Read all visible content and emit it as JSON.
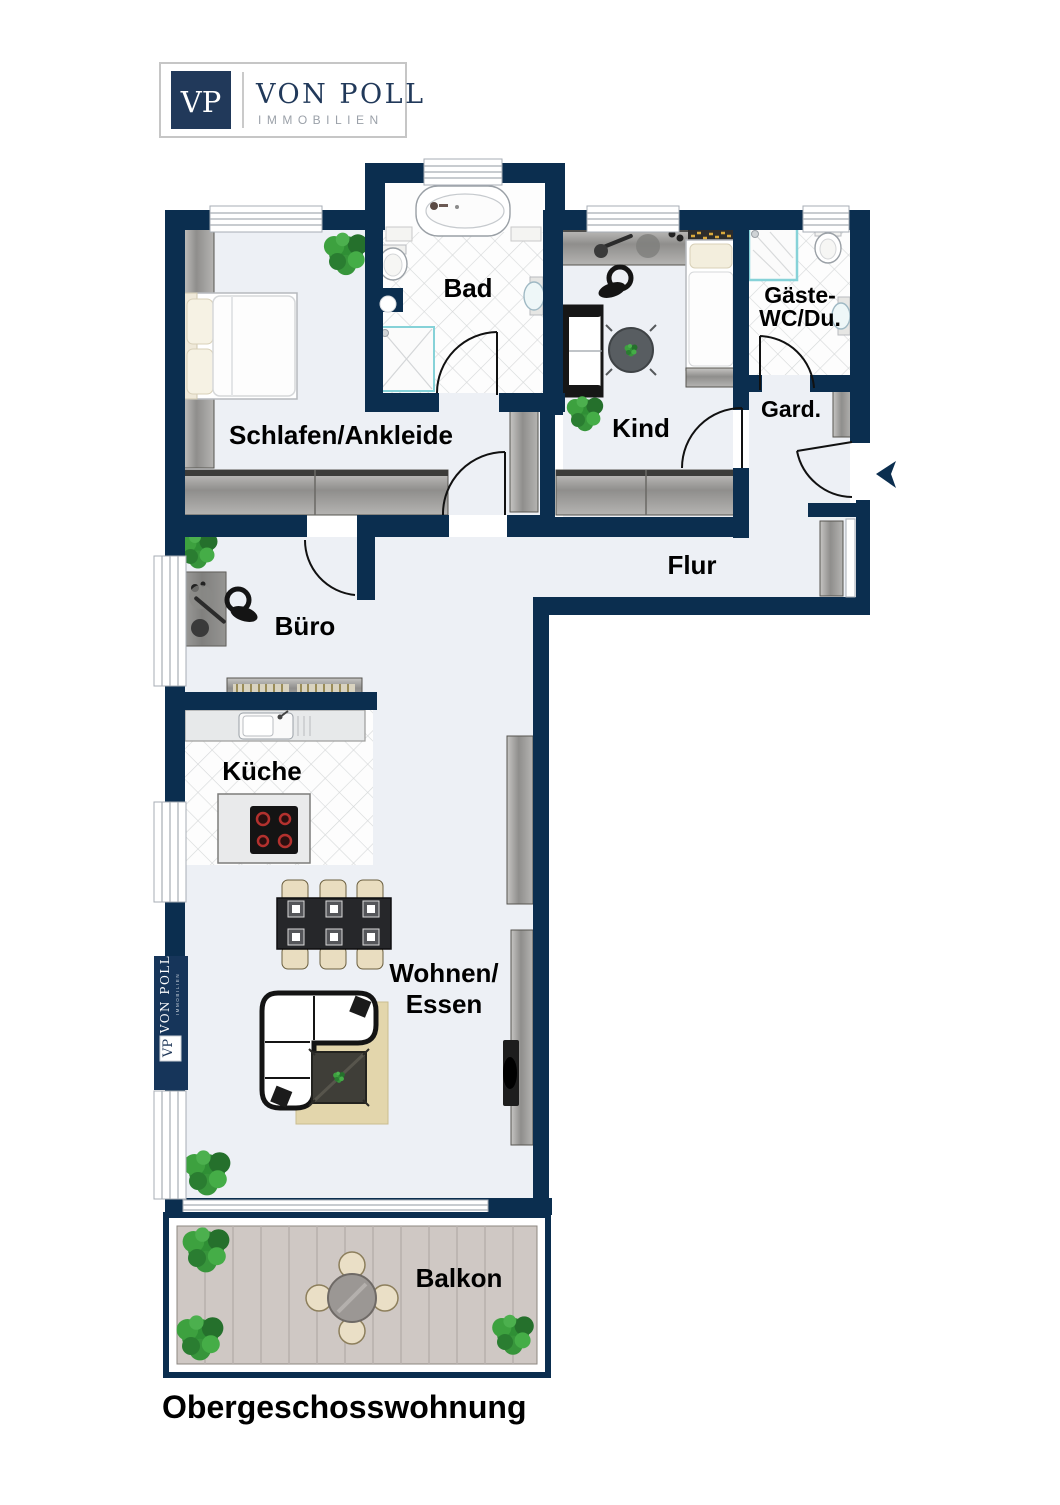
{
  "logo": {
    "monogram": "VP",
    "brand": "VON POLL",
    "division": "IMMOBILIEN"
  },
  "watermark": {
    "brand": "VON POLL",
    "division": "IMMOBILIEN",
    "monogram": "VP"
  },
  "plan_title": "Obergeschosswohnung",
  "rooms": {
    "bad": {
      "label": "Bad"
    },
    "schlafen": {
      "label": "Schlafen/Ankleide"
    },
    "kind": {
      "label": "Kind"
    },
    "gaeste": {
      "label_line1": "Gäste-",
      "label_line2": "WC/Du."
    },
    "gard": {
      "label": "Gard."
    },
    "flur": {
      "label": "Flur"
    },
    "buero": {
      "label": "Büro"
    },
    "kueche": {
      "label": "Küche"
    },
    "wohnen": {
      "label_line1": "Wohnen/",
      "label_line2": "Essen"
    },
    "balkon": {
      "label": "Balkon"
    }
  },
  "colors": {
    "wall": "#0b2e4f",
    "floor": "#edf0f5",
    "logo_navy": "#21395a",
    "text_gray": "#9ba1a9",
    "furniture_gray": "#9c9b99",
    "deck_wood": "#cfc8c4",
    "plant_green": "#2f8f35",
    "rug_beige": "#e3d6ac"
  }
}
